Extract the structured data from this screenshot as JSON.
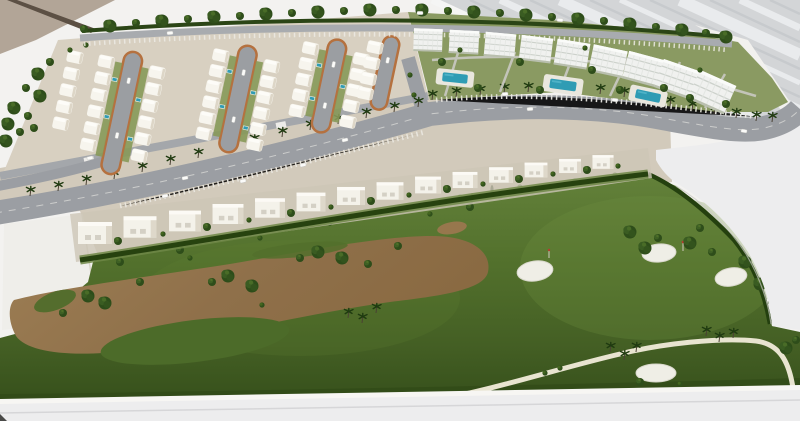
{
  "meta": {
    "kind": "photograph",
    "subject": "Architectural scale model of a resort residential development beside a golf course",
    "viewpoint": "oblique aerial view of tabletop maquette"
  },
  "scene": {
    "background": {
      "wall": "tan wall in top-left corner with dark corner edge line",
      "panel": "light grey panel with diagonal white stripes in top-right corner",
      "table": "white display table visible on right, left and bottom edges"
    },
    "districts": [
      {
        "name": "villa-district",
        "description": "dense rows of white barrel-roof villas around cul-de-sac streets",
        "culdesac_count": 4
      },
      {
        "name": "apartment-district",
        "description": "row of white multi-storey apartment blocks with garden courtyards",
        "block_count": 9,
        "pool_count": 3
      },
      {
        "name": "villas-row",
        "description": "row of modern white villas along the boulevard",
        "villa_count": 14
      }
    ],
    "roads": {
      "boulevard": "palm-lined avenue sweeping from lower-left up around the apartment blocks",
      "top_road": "tree-lined boundary road along the top edge",
      "cart_path": "cream golf cart path at bottom right"
    },
    "golf": {
      "bunker_count": 4,
      "sand_wash": "large brown sandy waste area crossing the fairway",
      "flags": 2
    }
  },
  "palette": {
    "bg": "#f3f2f0",
    "wall": "#b2a597",
    "wallEdge": "#5c5044",
    "panel": "#d3d5d7",
    "table": "#ededee",
    "ground": "#d2cabb",
    "districtGround": "#d8d0c1",
    "aptLawn": "#8a9a62",
    "pad": "#efeeea",
    "sand": "#97774d",
    "bunker": "#efeee6",
    "poolWater": "#2f9cb4",
    "cartPath": "#e8e4d0",
    "road": "#9b9ea3",
    "curb": "#b5713f",
    "hedge": "#27420f",
    "villaWhite": "#f7f5ee",
    "aptWhite": "#f0f1ef",
    "treeDark": "#2e4d1a",
    "golfDeep": "#36501b"
  }
}
